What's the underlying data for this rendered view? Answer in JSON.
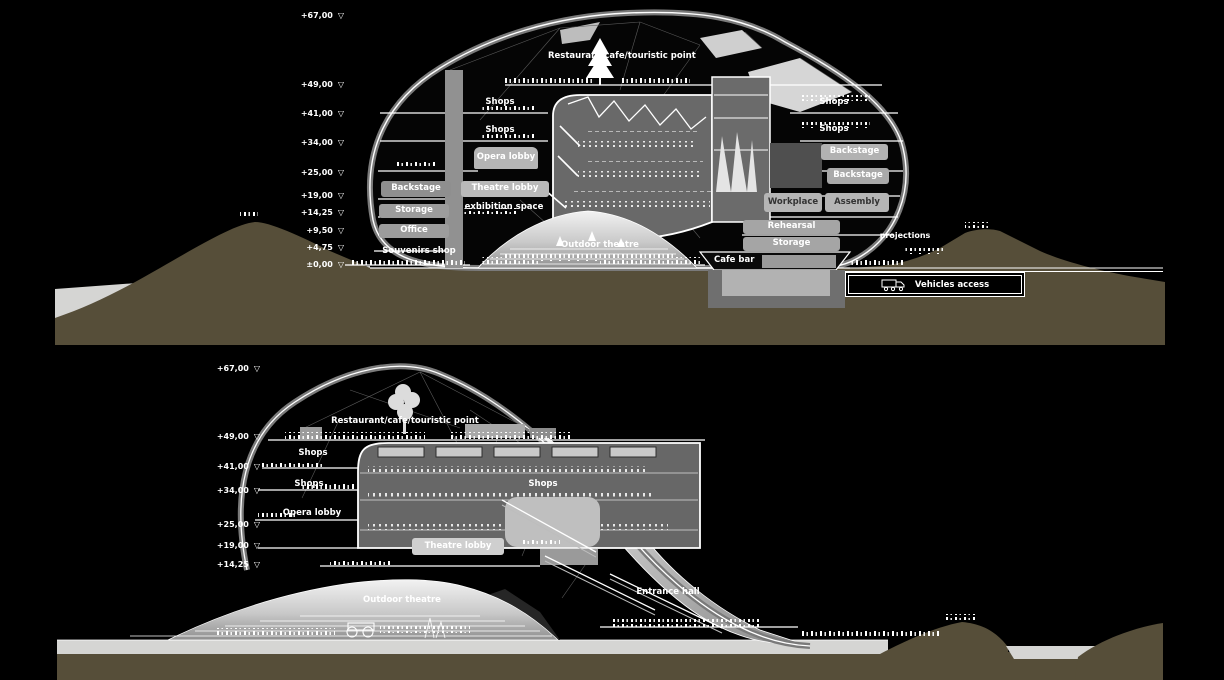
{
  "colors": {
    "background": "#000000",
    "ground": "#564e39",
    "surface": "#d5d5d3",
    "building_gray": "#7a7a7a",
    "line_white": "#ffffff"
  },
  "top_section": {
    "levels": [
      "+67,00",
      "+49,00",
      "+41,00",
      "+34,00",
      "+25,00",
      "+19,00",
      "+14,25",
      "+9,50",
      "+4,75",
      "±0,00"
    ],
    "labels": {
      "restaurant": "Restaurant/cafe/touristic point",
      "shops_a": "Shops",
      "shops_b": "Shops",
      "opera_lobby": "Opera lobby",
      "backstage_left": "Backstage",
      "theatre_lobby": "Theatre lobby",
      "exhibition_space": "exhibition space",
      "storage_left": "Storage",
      "office": "Office",
      "souvenirs_shop": "Souvenirs shop",
      "outdoor_theatre": "Outdoor theatre",
      "shops_c": "Shops",
      "shops_d": "Shops",
      "backstage_r1": "Backstage",
      "backstage_r2": "Backstage",
      "workplace": "Workplace",
      "assembly": "Assembly",
      "rehearsal": "Rehearsal",
      "storage_right": "Storage",
      "cafe_bar": "Cafe bar",
      "projections": "projections",
      "vehicles_access": "Vehicles access"
    }
  },
  "bottom_section": {
    "levels": [
      "+67,00",
      "+49,00",
      "+41,00",
      "+34,00",
      "+25,00",
      "+19,00",
      "+14,25"
    ],
    "labels": {
      "restaurant": "Restaurant/cafe/touristic point",
      "shops_a": "Shops",
      "shops_b": "Shops",
      "shops_c": "Shops",
      "opera_lobby": "Opera lobby",
      "theatre_lobby": "Theatre lobby",
      "outdoor_theatre": "Outdoor theatre",
      "entrance_hall": "Entrance hall"
    }
  }
}
